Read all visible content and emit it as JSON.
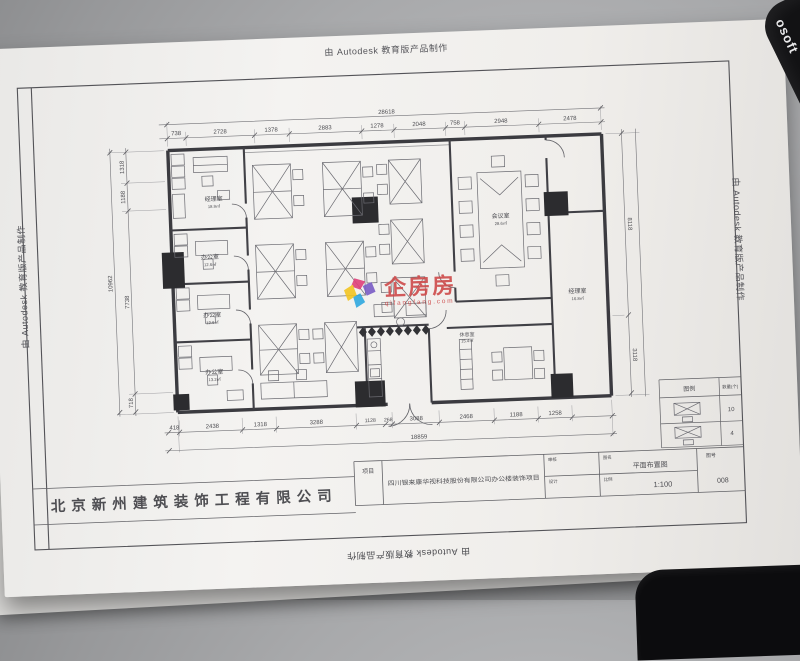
{
  "scene": {
    "mousepad_brand_fragment": "osoft"
  },
  "sheet": {
    "autodesk_credit": "由 Autodesk 教育版产品制作",
    "company_name": "北京新州建筑装饰工程有限公司"
  },
  "watermark": {
    "brand": "企房房",
    "subtext": "qifangfang.com",
    "brand_color": "#ce4a4a",
    "logo_colors": {
      "yellow": "#f2c522",
      "magenta": "#e0407a",
      "blue": "#2fa8e0",
      "purple": "#7a5cc5"
    }
  },
  "plan": {
    "rooms": {
      "manager_top_left": {
        "name": "经理室",
        "area": "18.9㎡"
      },
      "office_2": {
        "name": "办公室",
        "area": "12.6㎡"
      },
      "office_3": {
        "name": "办公室",
        "area": "12.6㎡"
      },
      "office_4": {
        "name": "办公室",
        "area": "13.2㎡"
      },
      "meeting": {
        "name": "会议室",
        "area": "28.6㎡"
      },
      "manager_right": {
        "name": "经理室",
        "area": "16.8㎡"
      },
      "break_room": {
        "name": "休息室",
        "area": "15.4㎡"
      }
    },
    "dims": {
      "top": [
        "738",
        "2728",
        "1378",
        "2883",
        "1278",
        "2048",
        "758",
        "2948",
        "2478"
      ],
      "top_total": "28618",
      "bottom": [
        "418",
        "2438",
        "1318",
        "3288",
        "1128",
        "268",
        "3088",
        "2468",
        "1188",
        "1258"
      ],
      "bottom_total": "18859",
      "left": [
        "1318",
        "1188",
        "7738",
        "718"
      ],
      "left_total": "10962",
      "right": [
        "8118",
        "3118"
      ]
    }
  },
  "legend": {
    "col_symbol": "图例",
    "col_qty": "数量(个)",
    "rows": [
      {
        "qty": "10"
      },
      {
        "qty": "4"
      }
    ]
  },
  "title_block": {
    "project_label": "项目",
    "project_name": "四川银来康华视科技股份有限公司办公楼装饰项目",
    "review_label": "审核",
    "design_label": "设计",
    "drawing_label": "图名",
    "drawing_name": "平面布置图",
    "scale_label": "比例",
    "scale_value": "1:100",
    "no_label": "图号",
    "no_value": "008"
  }
}
